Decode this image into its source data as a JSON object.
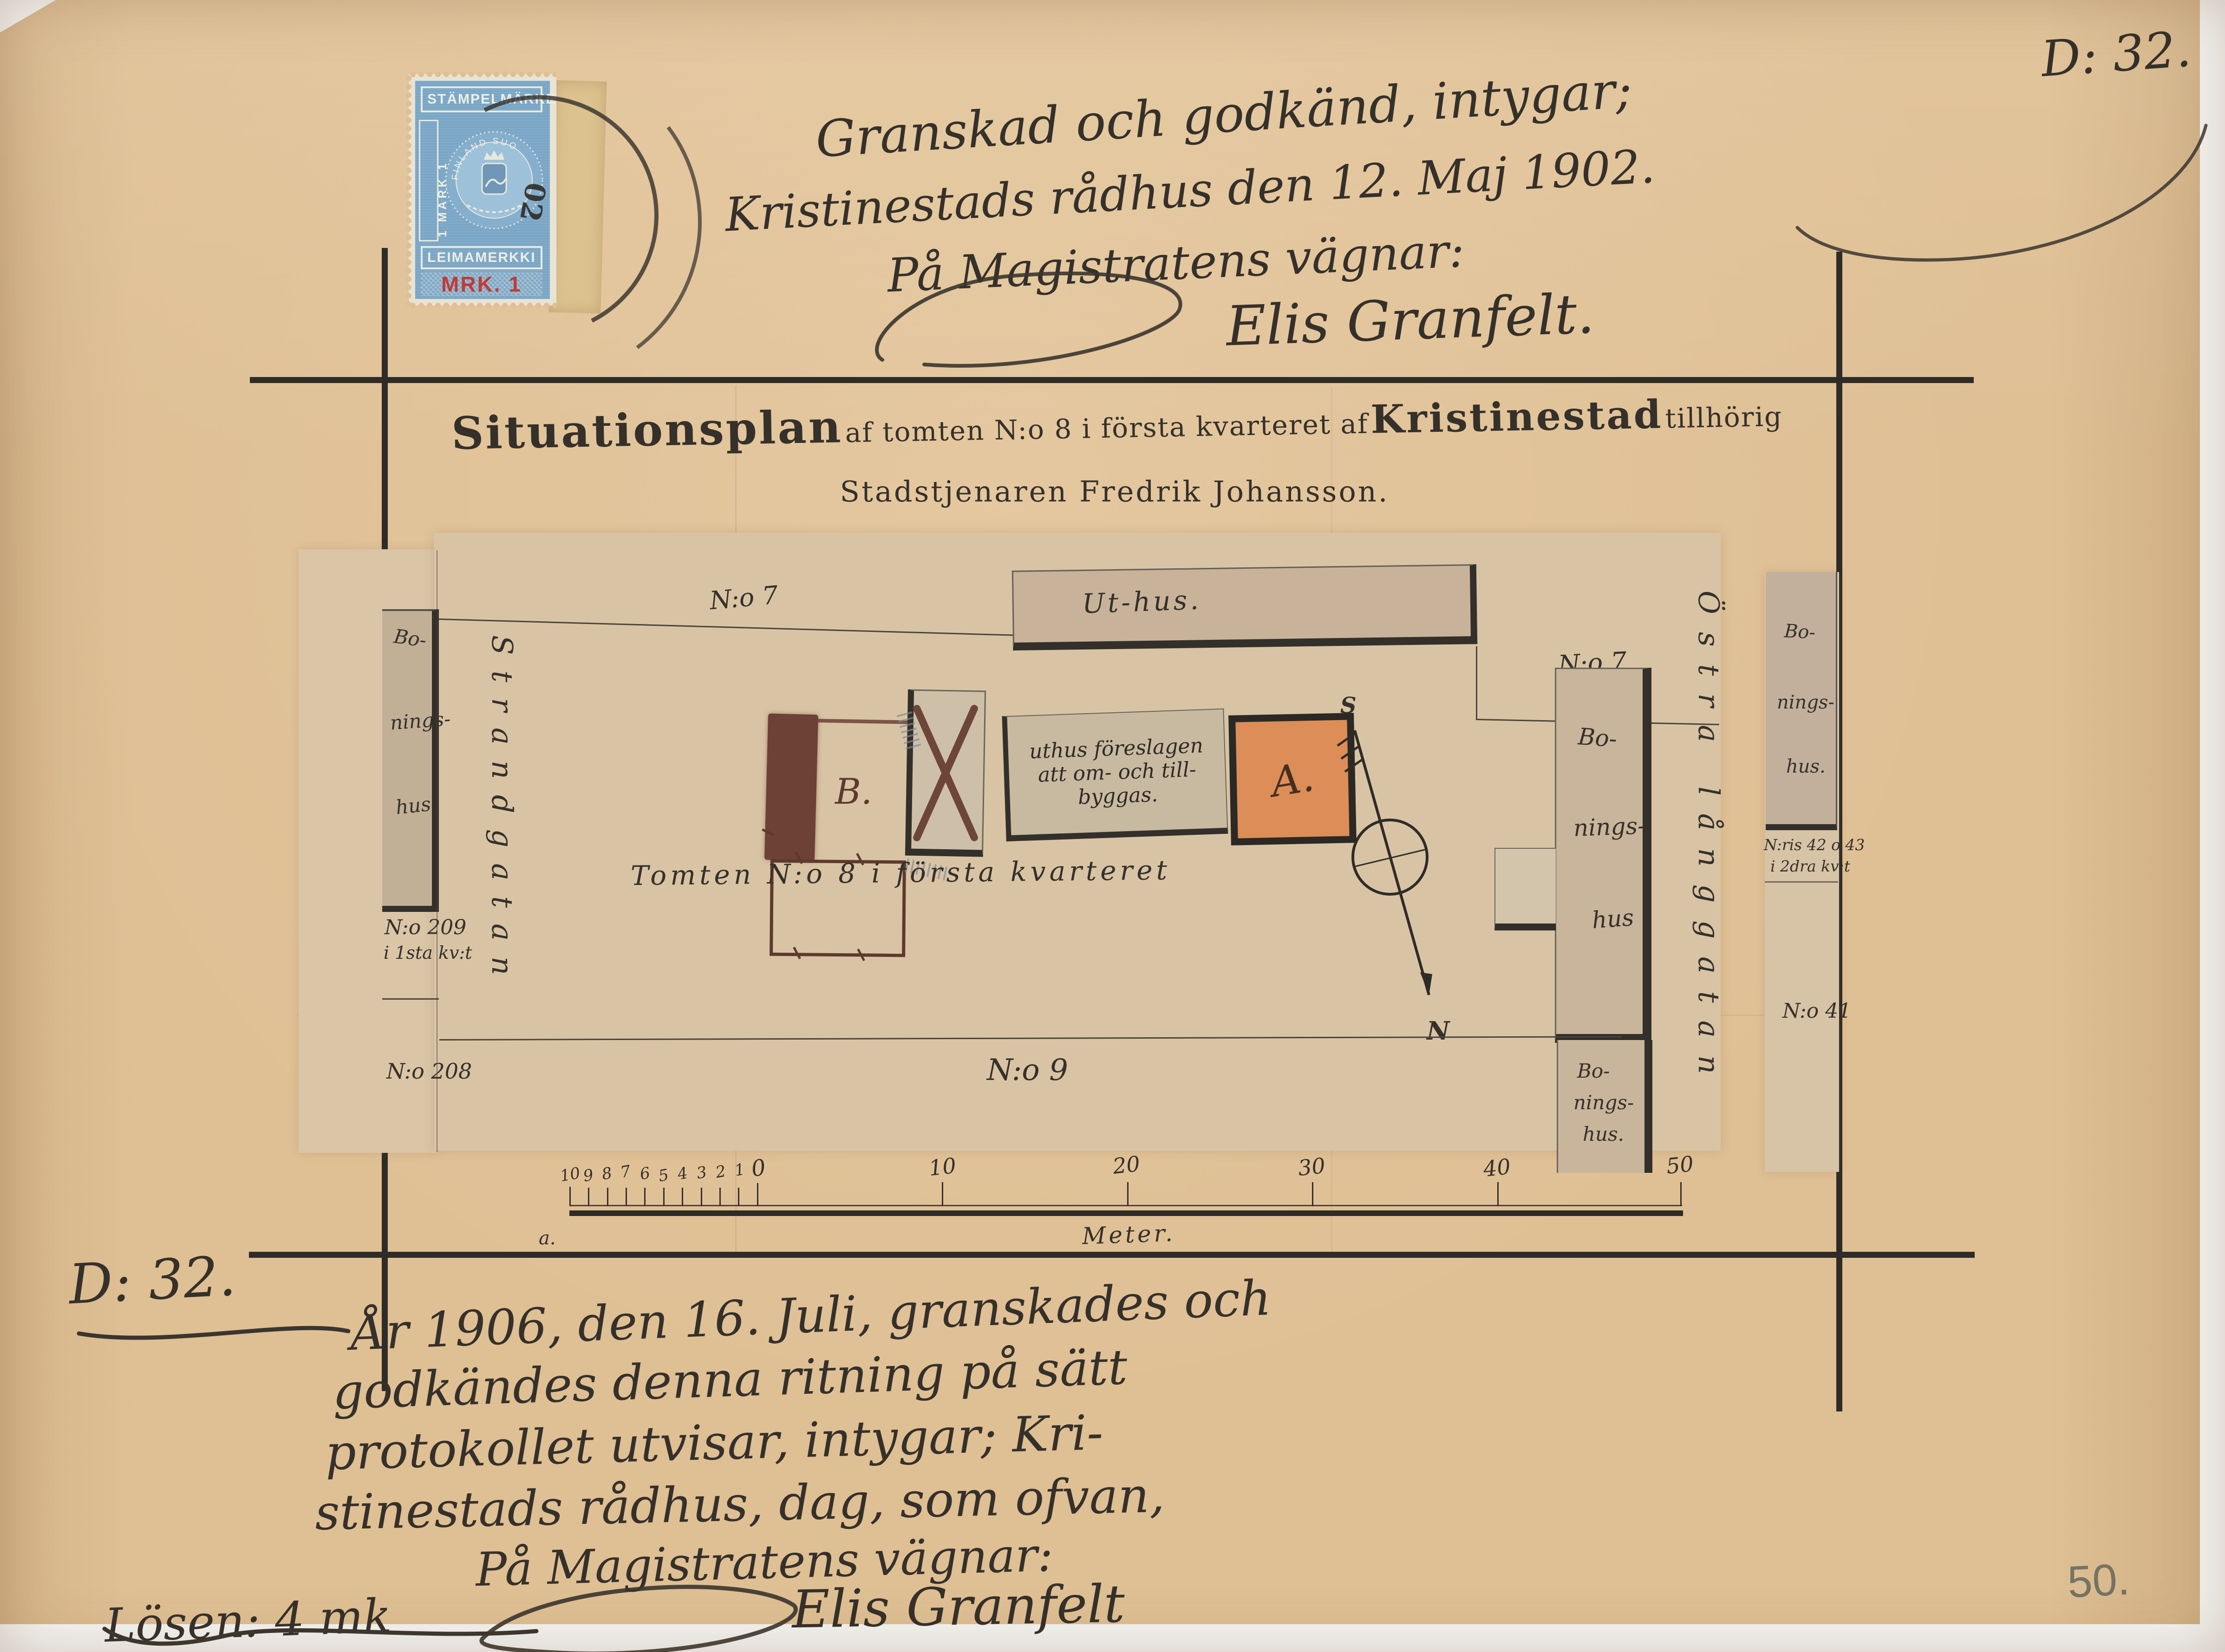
{
  "refs": {
    "top_right": "D: 32.",
    "bottom_left": "D: 32."
  },
  "pencil_number": "50.",
  "colors": {
    "paper": "#dfbf94",
    "sheet": "#d8c4a4",
    "ink": "#35302a",
    "stamp_blue": "#7ba6c6",
    "value_red": "#c23a35",
    "building_orange": "#dd8d57",
    "building_brown": "#6d4136",
    "wash_grey": "#c8b39a"
  },
  "stamp": {
    "top_band": "STÄMPELMÄRKE",
    "left_band": "1 MARK 1",
    "lower_band": "LEIMAMERKKI",
    "value": "MRK. 1",
    "emblem_ring": "FINLAND SUO",
    "cancel_digits": "02"
  },
  "approval_1902": {
    "line1": "Granskad och godkänd, intygar;",
    "line2": "Kristinestads rådhus den 12. Maj 1902.",
    "line3": "På Magistratens vägnar:",
    "signature": "Elis Granfelt."
  },
  "title": {
    "word_main": "Situationsplan",
    "segment": "af tomten N:o 8 i första kvarteret af",
    "city": "Kristinestad",
    "end": "tillhörig",
    "line2": "Stadstjenaren Fredrik Johansson."
  },
  "plan": {
    "streets": {
      "west": "Strandgatan",
      "east": "Östra långgatan"
    },
    "north_row": {
      "no7_left": "N:o 7",
      "uthus": "Ut-hus.",
      "no7_right": "N:o 7"
    },
    "tomten_label": "Tomten N:o 8 i första kvarteret",
    "south_label": "N:o 9",
    "building_a": "A.",
    "building_b": "B.",
    "annotation": [
      "uthus föreslagen",
      "att om- och till-",
      "byggas."
    ],
    "west_side": {
      "building": [
        "Bo-",
        "nings-",
        "hus."
      ],
      "lot_209": "N:o 209",
      "lot_209_qtr": "i 1sta kv:t",
      "lot_208": "N:o 208"
    },
    "east_inner": {
      "upper_building": [
        "Bo-",
        "nings-",
        "hus"
      ],
      "lower_building": [
        "Bo-",
        "nings-",
        "hus."
      ]
    },
    "east_side": {
      "building": [
        "Bo-",
        "nings-",
        "hus."
      ],
      "lots_42_43": "N:ris 42 o 43",
      "lots_qtr": "i 2dra kv:t",
      "lot_41": "N:o 41"
    },
    "compass": {
      "south": "S",
      "north": "N"
    },
    "scale": {
      "sub_ticks": [
        "10",
        "9",
        "8",
        "7",
        "6",
        "5",
        "4",
        "3",
        "2",
        "1"
      ],
      "zero": "0",
      "majors": [
        "10",
        "20",
        "30",
        "40",
        "50"
      ],
      "unit": "Meter.",
      "mark": "a."
    }
  },
  "approval_1906": {
    "line1": "År 1906, den 16. Juli, granskades och",
    "line2": "godkändes denna ritning på sätt",
    "line3": "protokollet utvisar, intygar; Kri-",
    "line4": "stinestads rådhus, dag, som ofvan,",
    "line5": "På Magistratens vägnar:",
    "signature": "Elis Granfelt",
    "fee": "Lösen: 4 mk"
  }
}
